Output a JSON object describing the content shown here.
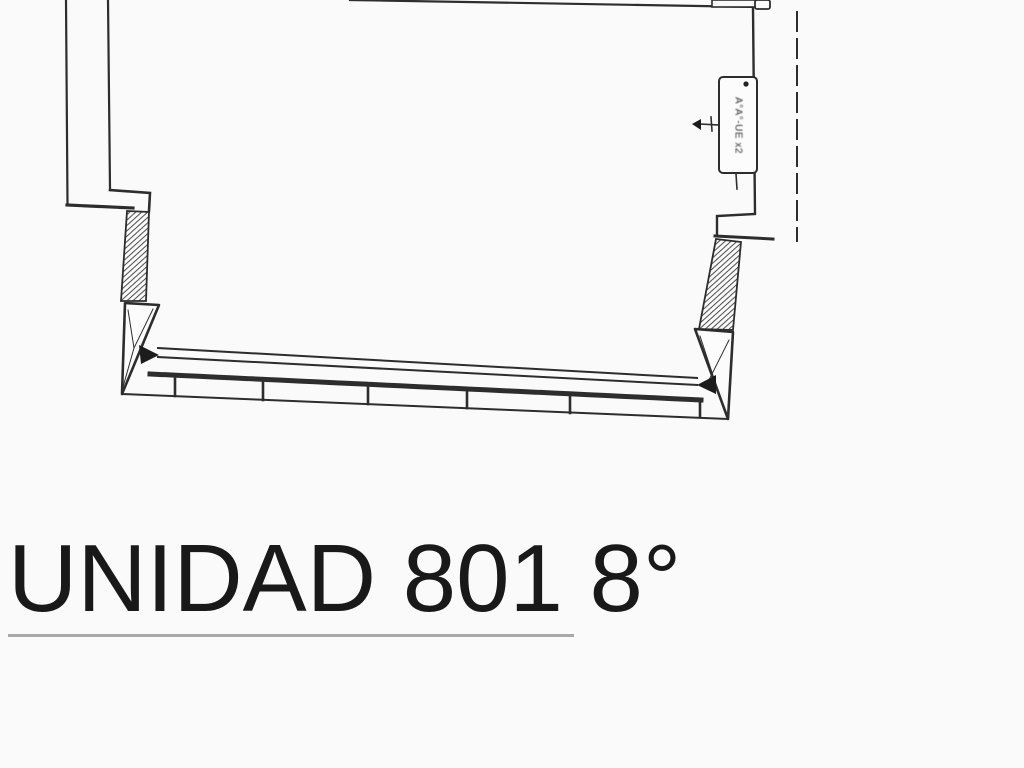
{
  "image": {
    "kind": "scanned architectural floor plan fragment",
    "background": "#fafafa"
  },
  "colors": {
    "line": "#2d2d2d",
    "title_text": "#191919",
    "underline": "#a8a8a8",
    "background": "#fafafa"
  },
  "title": {
    "text": "UNIDAD 801 8°"
  },
  "plan": {
    "ac_label": {
      "text": "A°A°-UE x2",
      "orientation": "rotated-90-clockwise"
    }
  }
}
